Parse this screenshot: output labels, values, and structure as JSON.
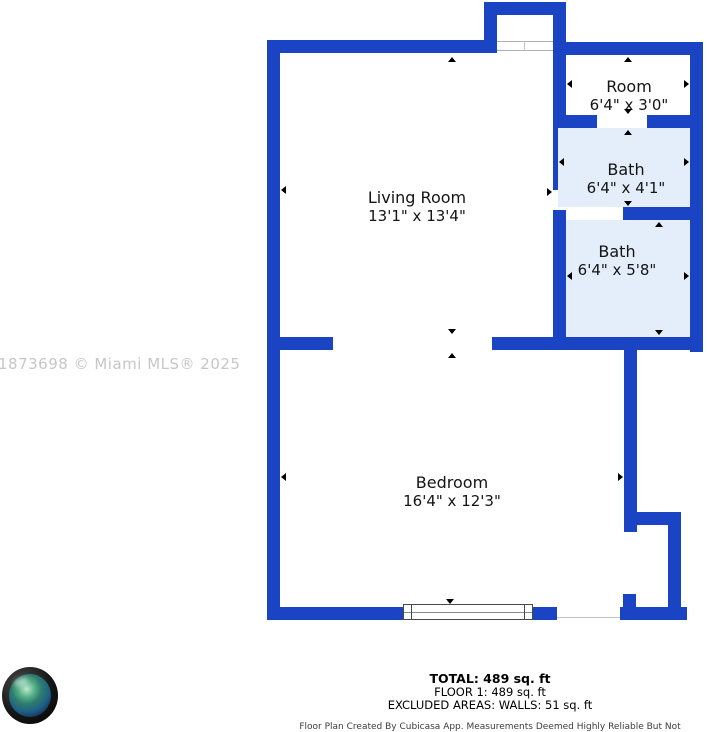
{
  "watermark": "1873698 © Miami MLS® 2025",
  "colors": {
    "wall": "#1b44c5",
    "bath_fill": "#e4eefb",
    "watermark": "#c7c7c7"
  },
  "rooms": [
    {
      "id": "living-room",
      "name": "Living Room",
      "dimensions": "13'1\" x 13'4\""
    },
    {
      "id": "room",
      "name": "Room",
      "dimensions": "6'4\" x 3'0\""
    },
    {
      "id": "bath-1",
      "name": "Bath",
      "dimensions": "6'4\" x 4'1\""
    },
    {
      "id": "bath-2",
      "name": "Bath",
      "dimensions": "6'4\" x 5'8\""
    },
    {
      "id": "bedroom",
      "name": "Bedroom",
      "dimensions": "16'4\" x 12'3\""
    }
  ],
  "summary": {
    "total": "TOTAL: 489 sq. ft",
    "floor": "FLOOR 1: 489 sq. ft",
    "excluded": "EXCLUDED AREAS: WALLS: 51 sq. ft"
  },
  "disclaimer": "Floor Plan Created By Cubicasa App. Measurements Deemed Highly Reliable But Not Guaranteed."
}
